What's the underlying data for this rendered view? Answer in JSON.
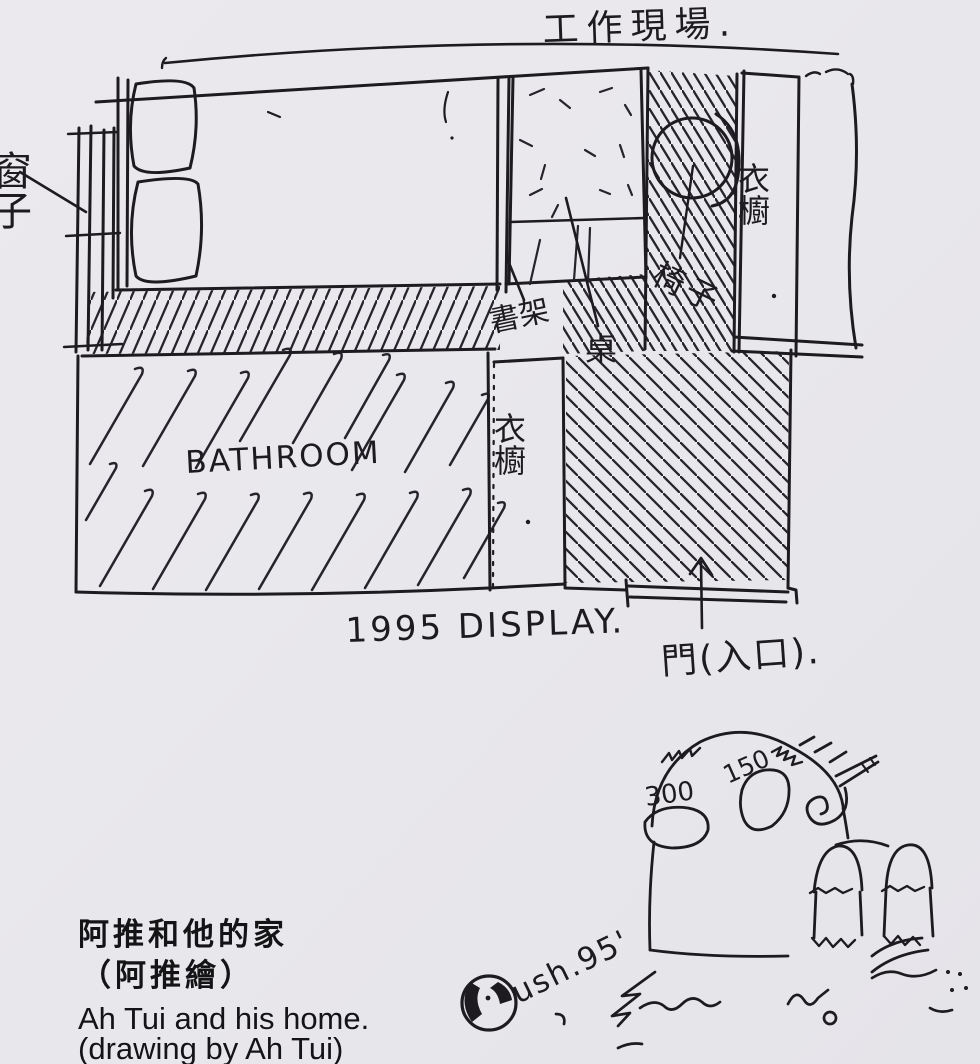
{
  "page": {
    "paper_color": "#e9e8ec",
    "ink_color": "#1d1b20"
  },
  "plan": {
    "title": "工作現場.",
    "labels": {
      "window": "窗子",
      "bookshelf": "書架",
      "desk": "桌",
      "chair": "椅子",
      "wardrobe_right": "衣櫥",
      "wardrobe_middle": "衣櫥",
      "bathroom": "BATHROOM",
      "display": "1995 DISPLAY.",
      "door": "門(入口)."
    }
  },
  "doodle": {
    "number_left": "300",
    "number_right": "150",
    "signature": "ush.95'"
  },
  "caption": {
    "title_zh": "阿推和他的家",
    "credit_zh": "（阿推繪）",
    "title_en": "Ah Tui and his home.",
    "credit_en": "(drawing by Ah Tui)"
  }
}
